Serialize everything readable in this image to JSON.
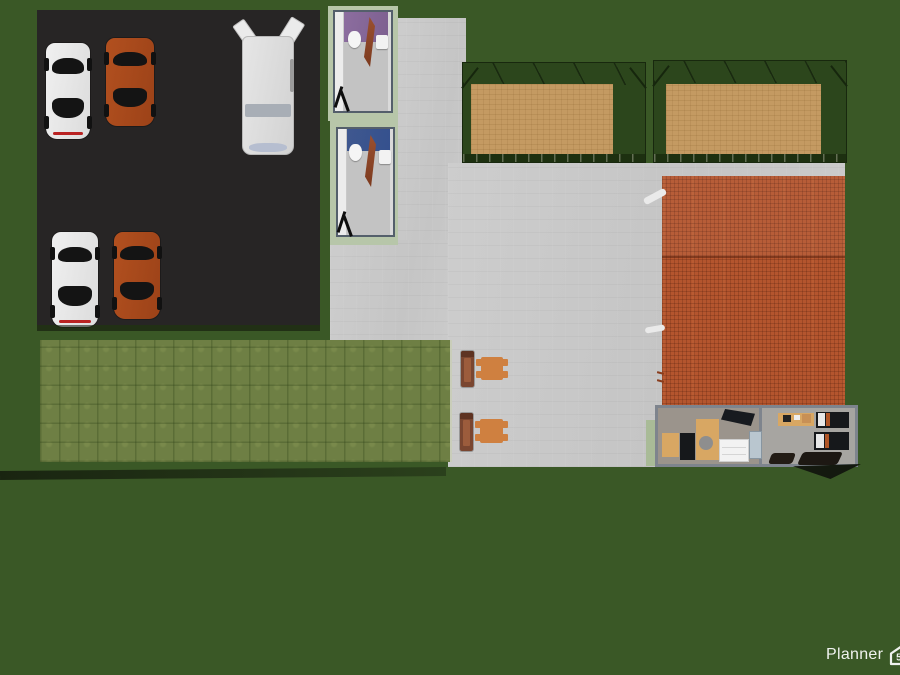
{
  "watermark": {
    "brand": "Planner",
    "badge": "5d"
  },
  "scene": {
    "view": "top-down 3D render of a property plan",
    "objects": {
      "parking_lot_vehicles": [
        "white-sports-car",
        "orange-sports-car",
        "white-cargo-van",
        "white-sports-car",
        "orange-sports-car"
      ],
      "bathrooms": [
        {
          "name": "bathroom-purple",
          "wall_color": "#8a6a9c",
          "fixtures": [
            "toilet",
            "sink",
            "open-door"
          ]
        },
        {
          "name": "bathroom-blue",
          "wall_color": "#3d5795",
          "fixtures": [
            "toilet",
            "sink",
            "open-door"
          ]
        }
      ],
      "sand_courts": 2,
      "patio": {
        "benches": 2,
        "tables": 2
      },
      "building": {
        "roof": "terracotta-tile",
        "rooms": [
          "kitchen-office",
          "office"
        ]
      }
    }
  },
  "colors": {
    "grass": "#3a5826",
    "lawn": "#6e7f44",
    "parking": "#272525",
    "concrete": "#c7c7c7",
    "sand": "#c49a62",
    "fence": "#2c461c",
    "pad": "#b7c6a9",
    "roof": "#b4552e",
    "bath1_wall": "#8a6a9c",
    "bath2_wall": "#3d5795",
    "car_white": "#e9e9e9",
    "car_orange": "#a8491d",
    "bench": "#7a4630",
    "bench_in": "#9c5c3c",
    "table": "#cf8040",
    "wood": "#d8a763",
    "office_wall": "#7e848d"
  }
}
